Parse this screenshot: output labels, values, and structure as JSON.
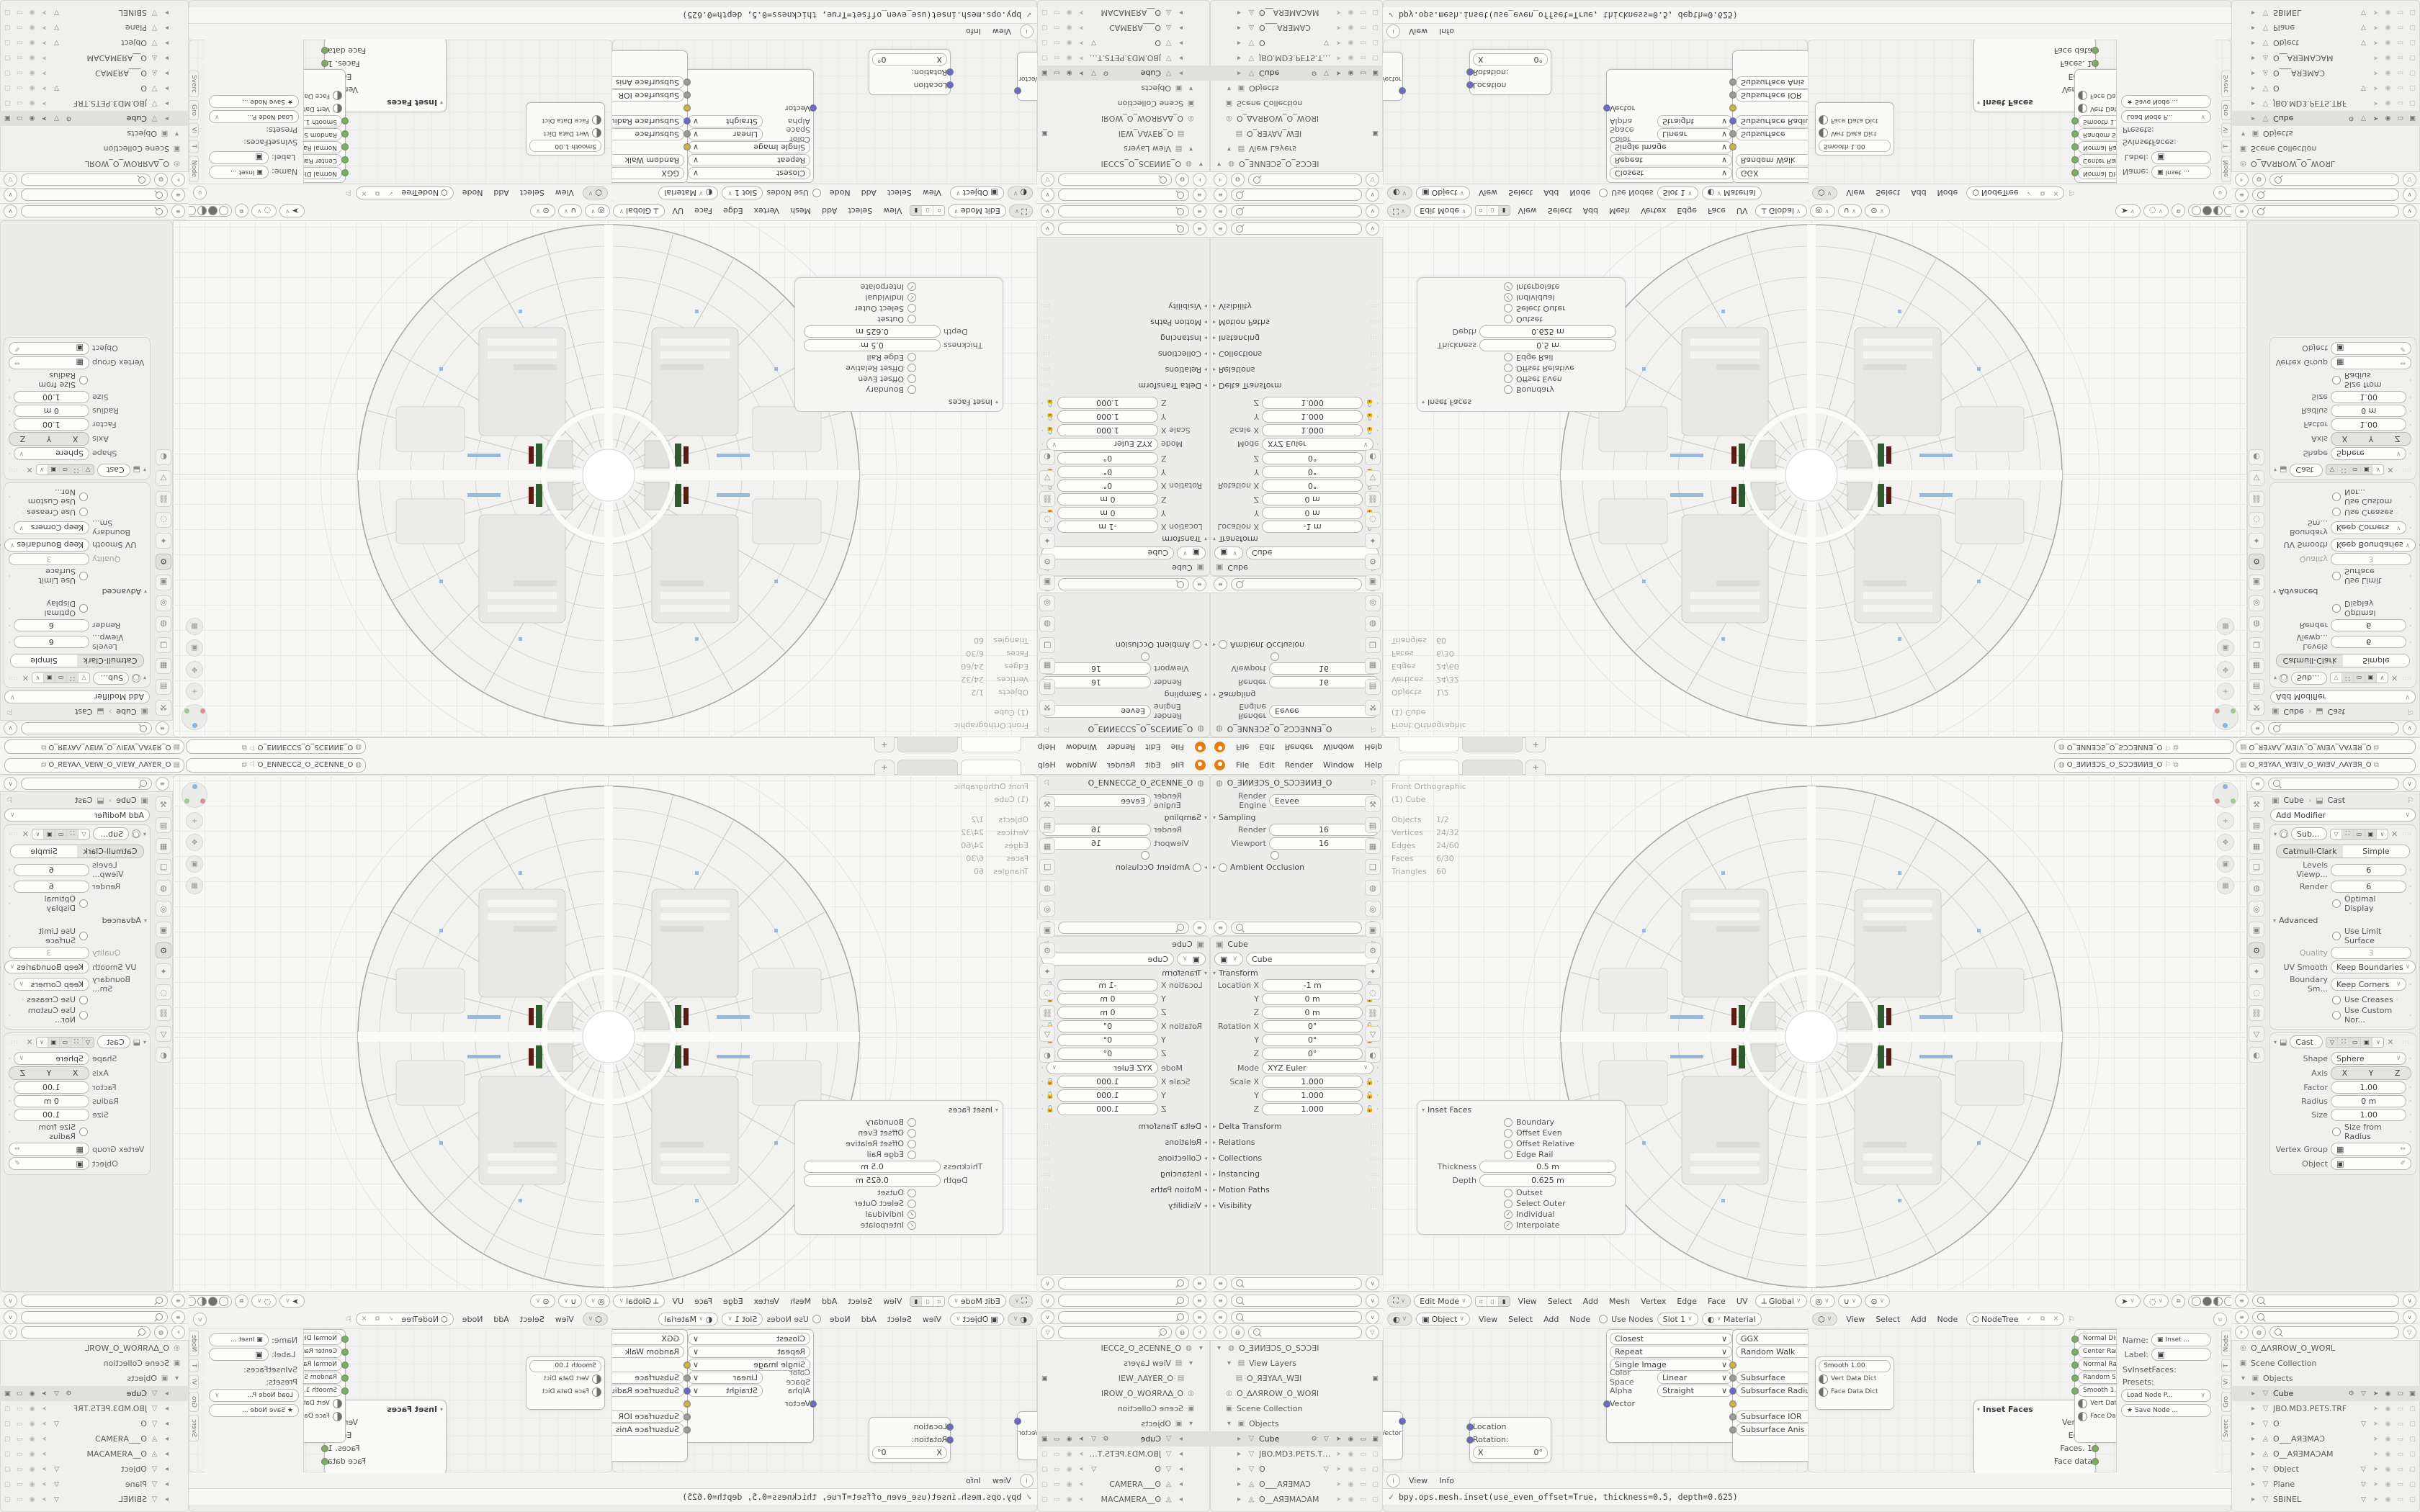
{
  "accent_colors": {
    "logo_orange": "#e87d0d",
    "socket_yellow": "#c9b144",
    "socket_blue": "#6a6ac4",
    "socket_orange": "#e0882d",
    "socket_green": "#79b059",
    "inset_green": "#2e5a2e",
    "inset_red": "#5a1b14"
  },
  "topbar": {
    "menus": [
      {
        "label": "File"
      },
      {
        "label": "Edit"
      },
      {
        "label": "Render"
      },
      {
        "label": "Window"
      },
      {
        "label": "Help"
      }
    ],
    "plus": "+",
    "scene_name": "O_ƎИИƎƆS_O_SƆƆƎИИƎ_O",
    "view_layer_name": "O_ЯƎYAΛ_WƎIV_O_WIƎV_ΛAYƎЯ_O",
    "pin_glyph": "⚐",
    "copy_glyph": "⧉",
    "chev": "∨"
  },
  "render_props": {
    "breadcrumb": "O_ƎИИƎƆS_O_SƆƆƎИИƎ_O",
    "engine_label": "Render Engine",
    "engine_value": "Eevee",
    "sampling_title": "Sampling",
    "sampling_rows": [
      {
        "label": "Render",
        "value": "16"
      },
      {
        "label": "Viewport",
        "value": "16"
      }
    ],
    "denoise_label": "Viewport Denoising",
    "ao_label": "Ambient Occlusion"
  },
  "object_props": {
    "breadcrumb": "Cube",
    "name_value": "Cube",
    "transform_title": "Transform",
    "xform_rows": [
      {
        "label": "Location X",
        "value": "-1 m"
      },
      {
        "label": "Y",
        "value": "0 m"
      },
      {
        "label": "Z",
        "value": "0 m"
      },
      {
        "label": "Rotation X",
        "value": "0°"
      },
      {
        "label": "Y",
        "value": "0°"
      },
      {
        "label": "Z",
        "value": "0°"
      }
    ],
    "mode_label": "Mode",
    "mode_value": "XYZ Euler",
    "scale_rows": [
      {
        "label": "Scale X",
        "value": "1.000"
      },
      {
        "label": "Y",
        "value": "1.000"
      },
      {
        "label": "Z",
        "value": "1.000"
      }
    ],
    "panels": [
      {
        "label": "Delta Transform"
      },
      {
        "label": "Relations"
      },
      {
        "label": "Collections"
      },
      {
        "label": "Instancing"
      },
      {
        "label": "Motion Paths"
      },
      {
        "label": "Visibility"
      }
    ]
  },
  "outliner_left": {
    "items": [
      {
        "cls": "orow",
        "pad": "padding-left:6px",
        "arrow": "▾",
        "icon": "◍",
        "label": "O_ƎИИƎƆS_O_SƆƆƎI"
      },
      {
        "cls": "orow",
        "pad": "padding-left:20px",
        "arrow": "▾",
        "icon": "▤",
        "label": "View Layers"
      },
      {
        "cls": "orow",
        "pad": "padding-left:34px",
        "icon": "▤",
        "label": "O_ЯƎYAΛ_WƎI",
        "cam_only": true
      },
      {
        "cls": "orow",
        "pad": "padding-left:20px",
        "icon": "◎",
        "label": "O_ΔΛЯROW_O_WOЯI"
      },
      {
        "cls": "orow",
        "pad": "padding-left:20px",
        "icon": "▣",
        "label": "Scene Collection"
      },
      {
        "cls": "orow",
        "pad": "padding-left:20px",
        "arrow": "▾",
        "icon": "▣",
        "label": "Objects"
      },
      {
        "cls": "orow sel",
        "pad": "padding-left:34px",
        "arrow": "▸",
        "icon": "▽",
        "label": "Cube",
        "mods": true,
        "tgl_full": true
      },
      {
        "cls": "orow",
        "pad": "padding-left:34px",
        "arrow": "▸",
        "icon": "▽",
        "label": "JBO.MD3.PETS.TRF",
        "tgl_dim": true
      },
      {
        "cls": "orow",
        "pad": "padding-left:34px",
        "arrow": "▸",
        "icon": "▽",
        "label": "O",
        "tri": true,
        "tgl_dim": true
      },
      {
        "cls": "orow",
        "pad": "padding-left:34px",
        "arrow": "▸",
        "icon": "◬",
        "label": "O___AЯƎMAƆ",
        "tgl_dim": true
      },
      {
        "cls": "orow",
        "pad": "padding-left:34px",
        "arrow": "▸",
        "icon": "◬",
        "label": "O__AЯƎMAƆAM",
        "tgl_dim": true
      }
    ]
  },
  "outliner_right": {
    "items": [
      {
        "cls": "orow",
        "pad": "padding-left:10px",
        "icon": "◎",
        "label": "O_ΔΛЯROW_O_WOЯL"
      },
      {
        "cls": "orow",
        "pad": "padding-left:10px",
        "icon": "▣",
        "label": "Scene Collection"
      },
      {
        "cls": "orow",
        "pad": "padding-left:10px",
        "arrow": "▾",
        "icon": "▣",
        "label": "Objects"
      },
      {
        "cls": "orow sel",
        "pad": "padding-left:24px",
        "arrow": "▸",
        "icon": "▽",
        "label": "Cube",
        "mods": true,
        "tgl_full": true
      },
      {
        "cls": "orow",
        "pad": "padding-left:24px",
        "arrow": "▸",
        "icon": "▽",
        "label": "JBO.MD3.PETS.TRF",
        "tgl_dim": true
      },
      {
        "cls": "orow",
        "pad": "padding-left:24px",
        "arrow": "▸",
        "icon": "▽",
        "label": "O",
        "tri": true,
        "tgl_dim": true
      },
      {
        "cls": "orow",
        "pad": "padding-left:24px",
        "arrow": "▸",
        "icon": "◬",
        "label": "O___AЯƎMAƆ",
        "tgl_dim": true
      },
      {
        "cls": "orow",
        "pad": "padding-left:24px",
        "arrow": "▸",
        "icon": "◬",
        "label": "O__AЯƎMAƆAM",
        "tgl_dim": true
      },
      {
        "cls": "orow",
        "pad": "padding-left:24px",
        "arrow": "▸",
        "icon": "▽",
        "label": "Object",
        "tri": true,
        "tgl_dim": true
      },
      {
        "cls": "orow",
        "pad": "padding-left:24px",
        "arrow": "▸",
        "icon": "▽",
        "label": "Plane",
        "tri": true,
        "tgl_dim": true
      },
      {
        "cls": "orow",
        "pad": "padding-left:24px",
        "arrow": "▸",
        "icon": "▽",
        "label": "SBINEL",
        "tri": true,
        "tgl_dim": true
      }
    ]
  },
  "viewport": {
    "overlay_line1": "Front Orthographic",
    "overlay_line2": "(1) Cube",
    "stats": [
      {
        "k": "Objects",
        "v": "1/2"
      },
      {
        "k": "Vertices",
        "v": "24/32"
      },
      {
        "k": "Edges",
        "v": "24/60"
      },
      {
        "k": "Faces",
        "v": "6/30"
      },
      {
        "k": "Triangles",
        "v": "60"
      }
    ],
    "header": {
      "mode": "Edit Mode",
      "menus": [
        {
          "label": "View"
        },
        {
          "label": "Select"
        },
        {
          "label": "Add"
        },
        {
          "label": "Mesh"
        },
        {
          "label": "Vertex"
        },
        {
          "label": "Edge"
        },
        {
          "label": "Face"
        },
        {
          "label": "UV"
        }
      ],
      "orientation": "Global"
    }
  },
  "inset_panel": {
    "title": "Inset Faces",
    "checks_top": [
      {
        "label": "Boundary"
      },
      {
        "label": "Offset Even"
      },
      {
        "label": "Offset Relative"
      },
      {
        "label": "Edge Rail"
      }
    ],
    "fields": [
      {
        "label": "Thickness",
        "value": "0.5 m"
      },
      {
        "label": "Depth",
        "value": "0.625 m"
      }
    ],
    "checks_bottom": [
      {
        "label": "Outset"
      },
      {
        "label": "Select Outer"
      },
      {
        "label": "Individual",
        "checked": true
      },
      {
        "label": "Interpolate",
        "checked": true
      }
    ]
  },
  "modifier_props": {
    "crumb_obj": "Cube",
    "crumb_sep": "›",
    "crumb_mod": "Cast",
    "add_modifier": "Add Modifier",
    "subsurf": {
      "name": "Sub...",
      "tabs_on": "Catmull-Clark",
      "tabs_off": "Simple",
      "rows": [
        {
          "label": "Levels Viewp...",
          "value": "6"
        },
        {
          "label": "Render",
          "value": "6"
        }
      ],
      "optimal": "Optimal Display",
      "advanced": "Advanced",
      "limit": "Use Limit Surface",
      "quality_label": "Quality",
      "quality_value": "3",
      "selects": [
        {
          "label": "UV Smooth",
          "value": "Keep Boundaries"
        },
        {
          "label": "Boundary Sm...",
          "value": "Keep Corners"
        }
      ],
      "checks2": [
        {
          "label": "Use Creases"
        },
        {
          "label": "Use Custom Nor..."
        }
      ]
    },
    "cast": {
      "name": "Cast",
      "shape_label": "Shape",
      "shape_value": "Sphere",
      "axis_label": "Axis",
      "axis": [
        {
          "label": "X"
        },
        {
          "label": "Y"
        },
        {
          "label": "Z"
        }
      ],
      "rows": [
        {
          "label": "Factor",
          "value": "1.00",
          "slider": true
        },
        {
          "label": "Radius",
          "value": "0 m"
        },
        {
          "label": "Size",
          "value": "1.00"
        }
      ],
      "check": "Size from Radius",
      "vg_label": "Vertex Group",
      "obj_label": "Object"
    }
  },
  "shader_editor": {
    "header": {
      "shader_type": "Object",
      "menus": [
        {
          "label": "View"
        },
        {
          "label": "Select"
        },
        {
          "label": "Add"
        },
        {
          "label": "Node"
        }
      ],
      "use_nodes": "Use Nodes",
      "slot": "Slot 1",
      "material": "Material"
    },
    "stub_out": "Vector",
    "mapping_node": {
      "rows": [
        {
          "label": "Location",
          "sock": "#6a6ac4"
        },
        {
          "label": "Rotation:",
          "sock": "#6a6ac4"
        }
      ],
      "field_label": "X",
      "field_value": "0°"
    },
    "image_node": {
      "pills": [
        {
          "label": "Closest"
        },
        {
          "label": "Repeat"
        },
        {
          "label": "Single Image"
        }
      ],
      "fields": [
        {
          "label": "Color Space",
          "value": "Linear"
        },
        {
          "label": "Alpha",
          "value": "Straight"
        }
      ],
      "input_label": "Vector",
      "input_color": "#6a6ac4"
    },
    "bsdf_node": {
      "rows": [
        {
          "pill": true,
          "label": "GGX"
        },
        {
          "pill": true,
          "label": "Random Walk"
        },
        {
          "pill": false,
          "label": "Base Color",
          "sock": "#c9b144"
        },
        {
          "pill": true,
          "label": "Subsurface",
          "sock": "#9a9a98"
        },
        {
          "pill": true,
          "label": "Subsurface Radiu",
          "sock": "#6a6ac4"
        },
        {
          "pill": false,
          "label": "Subsurface Color",
          "sock": "#c9b144"
        },
        {
          "pill": true,
          "label": "Subsurface IOR",
          "sock": "#9a9a98",
          "slider": true
        },
        {
          "pill": true,
          "label": "Subsurface Anis",
          "sock": "#9a9a98"
        }
      ]
    }
  },
  "sverchok": {
    "header": {
      "menus": [
        {
          "label": "View"
        },
        {
          "label": "Select"
        },
        {
          "label": "Add"
        },
        {
          "label": "Node"
        }
      ],
      "tree": "NodeTree",
      "check": "✓",
      "copy": "⧉",
      "x": "✕"
    },
    "nodeA_rows": [
      {
        "pill": true,
        "label": "Smooth    1.00"
      },
      {
        "pill": false,
        "label": "Vert Data Dict",
        "half": true
      },
      {
        "pill": false,
        "label": "Face Data Dict",
        "half": true
      }
    ],
    "inset_node": {
      "title": "Inset Faces",
      "grid_glyph": "⊞",
      "outputs": [
        {
          "label": "Verts. 1",
          "c": "#e0882d"
        },
        {
          "label": "Edges",
          "c": "#79b059"
        },
        {
          "label": "Faces. 1",
          "c": "#79b059"
        },
        {
          "label": "Face data",
          "c": "#79b059"
        }
      ]
    },
    "nodeB_rows": [
      {
        "pill": true,
        "label": "Normal Displ 0.0",
        "c": "#79b059"
      },
      {
        "pill": true,
        "label": "Center Rand 0.0",
        "c": "#79b059"
      },
      {
        "pill": true,
        "label": "Normal Ran  0.0",
        "c": "#79b059"
      },
      {
        "pill": true,
        "label": "Random Seed",
        "c": "#79b059"
      },
      {
        "pill": true,
        "label": "Smooth    1.00",
        "c": "#79b059"
      },
      {
        "pill": false,
        "label": "Vert Data Dict",
        "half": true
      },
      {
        "pill": false,
        "label": "Face Data Dict",
        "half": true
      }
    ]
  },
  "n_panel": {
    "tabs": [
      {
        "label": "Node"
      },
      {
        "label": "T"
      },
      {
        "label": "Vi"
      },
      {
        "label": "Gro"
      },
      {
        "label": "Sverc"
      }
    ],
    "name_label": "Name:",
    "name_value": "Inset ...",
    "label_label": "Label:",
    "type_label": "SvInsetFaces:",
    "presets_label": "Presets:",
    "load_btn": "Load Node P...",
    "save_btn": "Save Node ...",
    "save_glyph": "★"
  },
  "info_editor": {
    "menus": [
      {
        "label": "View"
      },
      {
        "label": "Info"
      }
    ],
    "log_check": "✓",
    "log": "bpy.ops.mesh.inset(use_even_offset=True, thickness=0.5, depth=0.625)"
  },
  "prop_tabs_left": [
    {
      "glyph": "⚒",
      "name": "tab-tool-icon"
    },
    {
      "glyph": "▤",
      "name": "tab-render-icon"
    },
    {
      "glyph": "▦",
      "name": "tab-output-icon"
    },
    {
      "glyph": "❏",
      "name": "tab-viewlayer-icon"
    },
    {
      "glyph": "◍",
      "name": "tab-scene-icon"
    },
    {
      "glyph": "◎",
      "name": "tab-world-icon"
    },
    {
      "glyph": "▣",
      "name": "tab-object-icon"
    },
    {
      "glyph": "⚙",
      "name": "tab-modifier-icon"
    },
    {
      "glyph": "✦",
      "name": "tab-particles-icon"
    },
    {
      "glyph": "◌",
      "name": "tab-physics-icon"
    },
    {
      "glyph": "⛓",
      "name": "tab-constraints-icon"
    },
    {
      "glyph": "▽",
      "name": "tab-data-icon"
    },
    {
      "glyph": "◐",
      "name": "tab-material-icon"
    }
  ],
  "prop_tabs_right": [
    {
      "glyph": "⚒",
      "name": "tab-tool-icon",
      "on": false
    },
    {
      "glyph": "▤",
      "name": "tab-render-icon"
    },
    {
      "glyph": "▦",
      "name": "tab-output-icon"
    },
    {
      "glyph": "❏",
      "name": "tab-viewlayer-icon"
    },
    {
      "glyph": "◍",
      "name": "tab-scene-icon"
    },
    {
      "glyph": "◎",
      "name": "tab-world-icon"
    },
    {
      "glyph": "▣",
      "name": "tab-object-icon"
    },
    {
      "glyph": "⚙",
      "name": "tab-modifier-icon",
      "on": true
    },
    {
      "glyph": "✦",
      "name": "tab-particles-icon"
    },
    {
      "glyph": "◌",
      "name": "tab-physics-icon"
    },
    {
      "glyph": "⛓",
      "name": "tab-constraints-icon"
    },
    {
      "glyph": "▽",
      "name": "tab-data-icon"
    },
    {
      "glyph": "◐",
      "name": "tab-material-icon"
    }
  ]
}
